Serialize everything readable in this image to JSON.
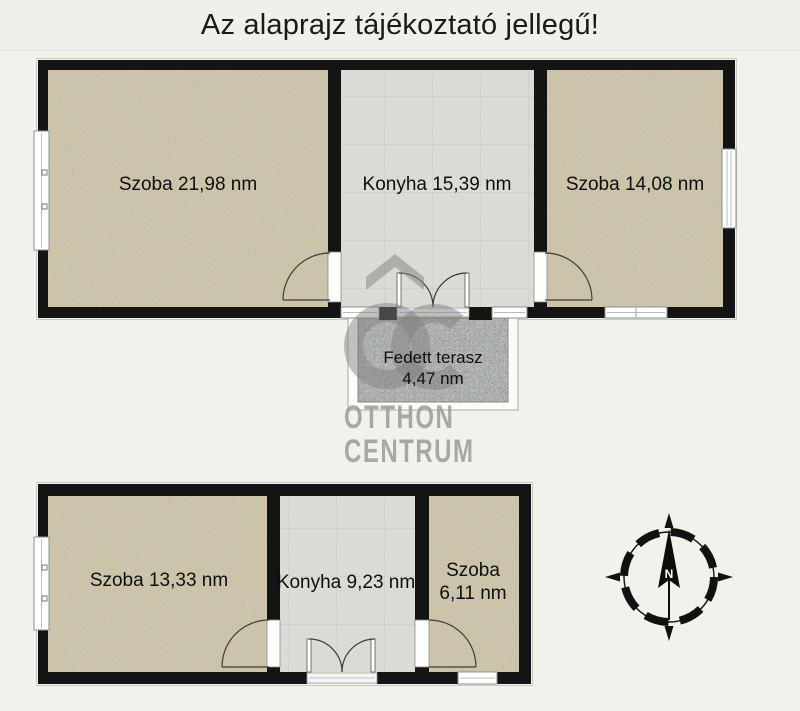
{
  "title": "Az alaprajz tájékoztató jellegű!",
  "upper_floor": {
    "rooms": [
      {
        "label": "Szoba 21,98 nm"
      },
      {
        "label": "Konyha 15,39 nm"
      },
      {
        "label": "Szoba 14,08 nm"
      }
    ],
    "terrace": {
      "name": "Fedett terasz",
      "area": "4,47 nm"
    }
  },
  "lower_floor": {
    "rooms": [
      {
        "label": "Szoba 13,33 nm"
      },
      {
        "label": "Konyha 9,23 nm"
      },
      {
        "name": "Szoba",
        "area": "6,11 nm"
      }
    ]
  },
  "watermark": {
    "monogram": "OC",
    "brand_line1": "OTTHON",
    "brand_line2": "CENTRUM"
  },
  "compass": {
    "north_label": "N"
  },
  "colors": {
    "background": "#f2f1ec",
    "wall": "#141414",
    "room_floor": "#d3ccb2",
    "kitchen_floor": "#dcded9",
    "terrace_floor": "#a9ada9",
    "watermark": "#8f8f8f"
  }
}
